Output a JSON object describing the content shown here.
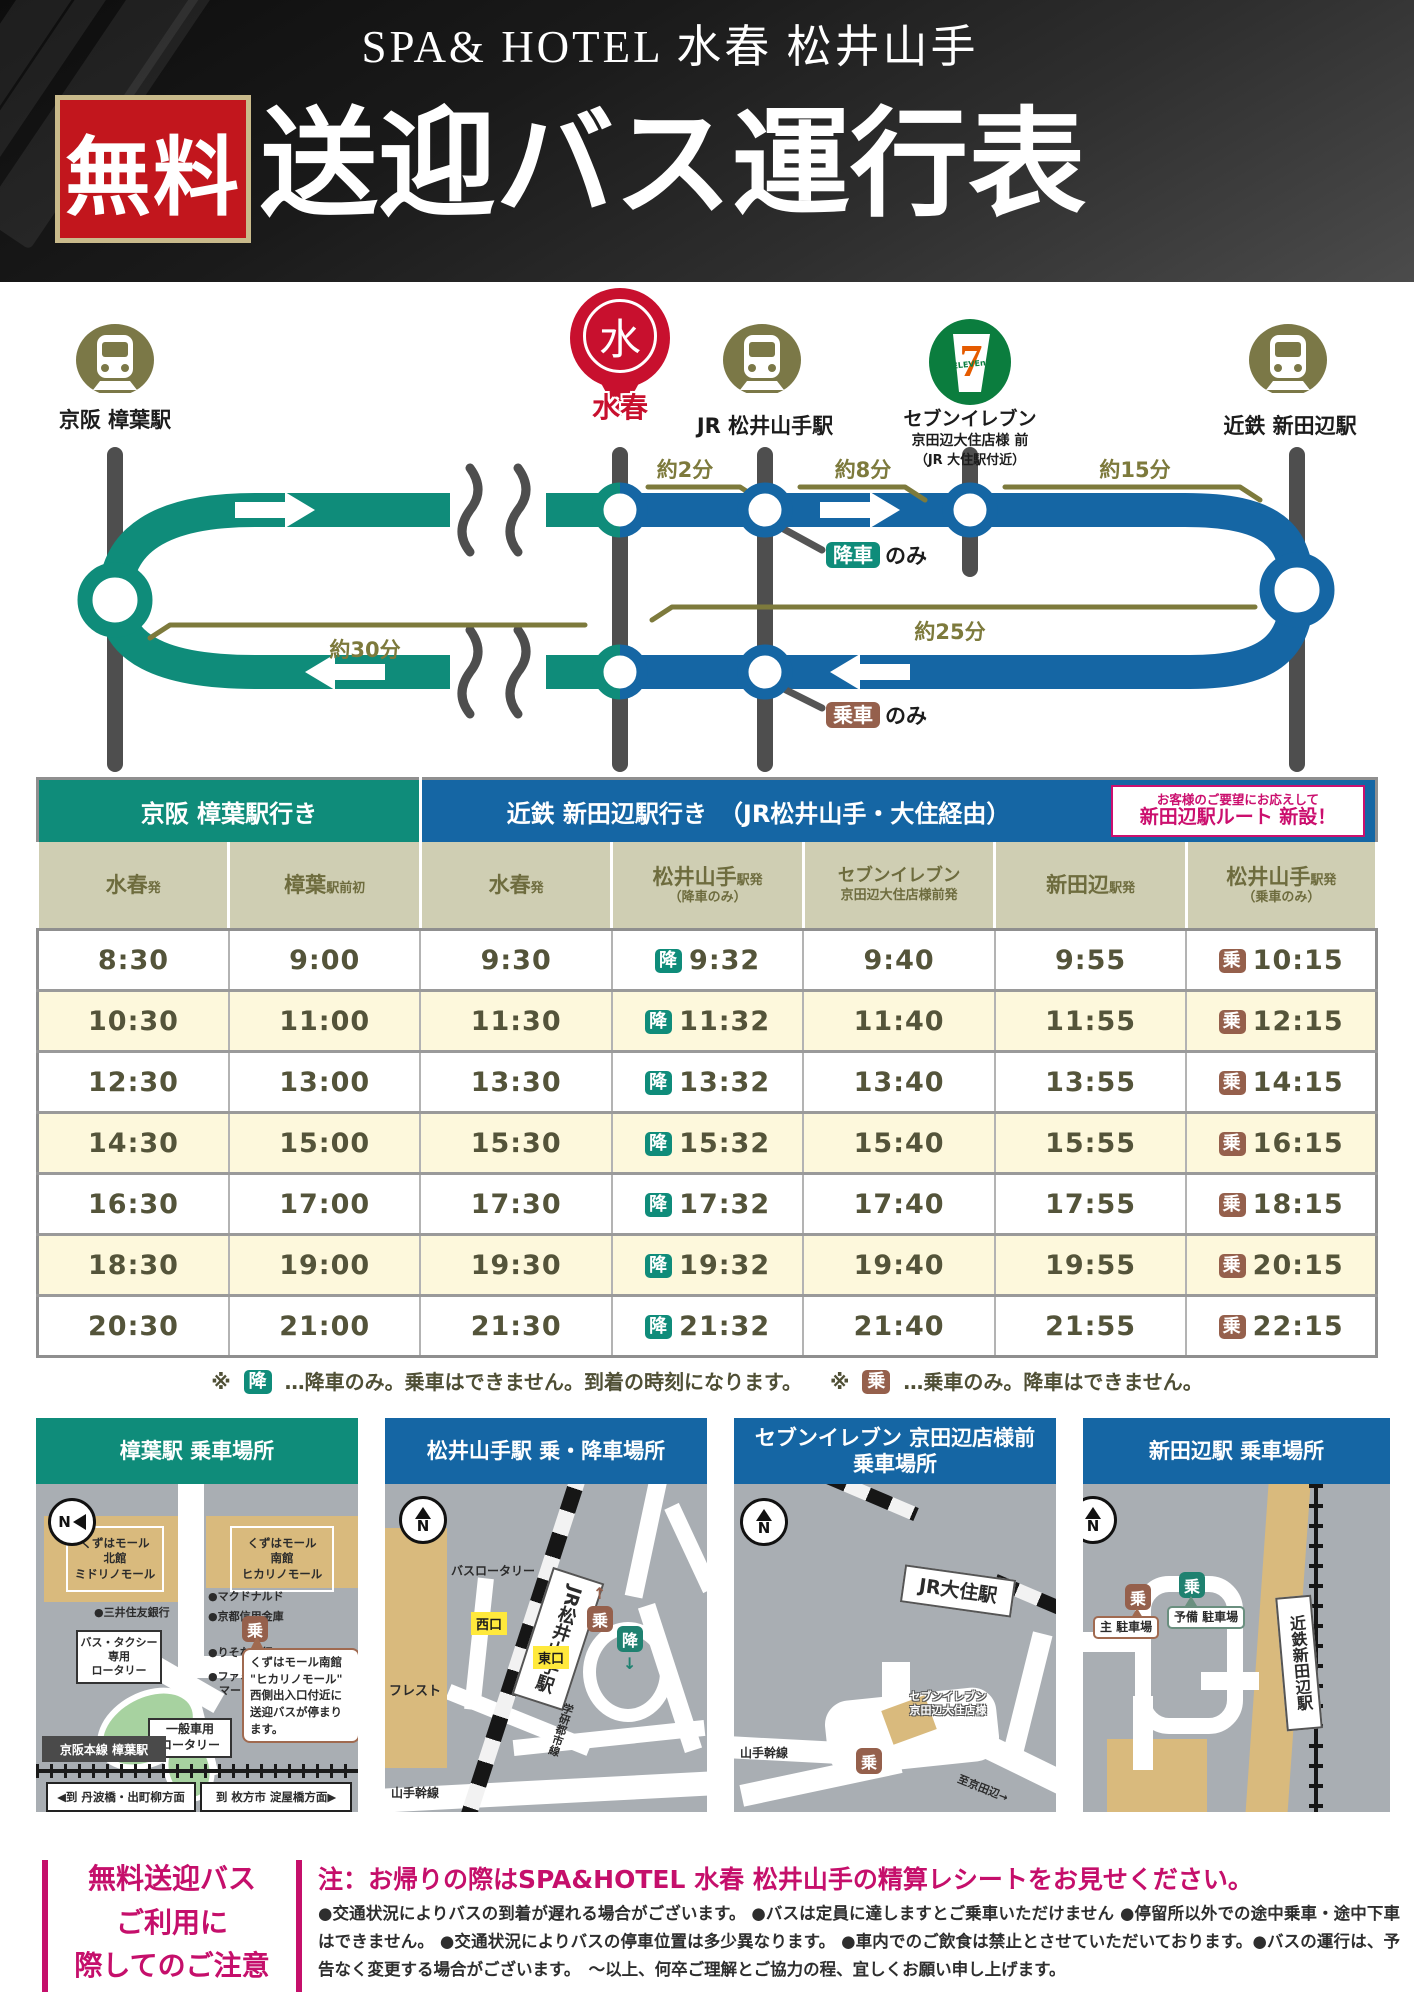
{
  "header": {
    "brand": "SPA& HOTEL 水春 松井山手",
    "free_badge": "無料",
    "title": "送迎バス運行表"
  },
  "route": {
    "colors": {
      "teal": "#0f8c7a",
      "blue": "#1566a4",
      "olive": "#7d7a3c"
    },
    "stations": {
      "kuzuha": {
        "label": "京阪 樟葉駅"
      },
      "suisyun": {
        "pin_char": "水",
        "pin_label": "水春"
      },
      "jr": {
        "label": "JR 松井山手駅"
      },
      "seven": {
        "label": "セブンイレブン",
        "sub1": "京田辺大住店様 前",
        "sub2": "（JR 大住駅付近）"
      },
      "kintetsu": {
        "label": "近鉄 新田辺駅"
      }
    },
    "durations": {
      "t2": "約2分",
      "t8": "約8分",
      "t15": "約15分",
      "t25": "約25分",
      "t30": "約30分"
    },
    "dropoff": {
      "badge": "降車",
      "suffix": "のみ"
    },
    "boarding": {
      "badge": "乗車",
      "suffix": "のみ"
    }
  },
  "timetable": {
    "direction_left": "京阪 樟葉駅行き",
    "direction_right": "近鉄 新田辺駅行き　（JR松井山手・大住経由）",
    "new_route_note_line1": "お客様のご要望にお応えして",
    "new_route_note_line2": "新田辺駅ルート 新設！",
    "drop_badge": "降",
    "board_badge": "乗",
    "columns": [
      {
        "main": "水春",
        "suffix": "発"
      },
      {
        "main": "樟葉",
        "suffix": "駅前初"
      },
      {
        "main": "水春",
        "suffix": "発"
      },
      {
        "main": "松井山手",
        "suffix": "駅発",
        "sub": "（降車のみ）"
      },
      {
        "main": "セブンイレブン",
        "suffix": "",
        "sub": "京田辺大住店様前発"
      },
      {
        "main": "新田辺",
        "suffix": "駅発"
      },
      {
        "main": "松井山手",
        "suffix": "駅発",
        "sub": "（乗車のみ）"
      }
    ],
    "rows": [
      [
        "8:30",
        "9:00",
        "9:30",
        "9:32",
        "9:40",
        "9:55",
        "10:15"
      ],
      [
        "10:30",
        "11:00",
        "11:30",
        "11:32",
        "11:40",
        "11:55",
        "12:15"
      ],
      [
        "12:30",
        "13:00",
        "13:30",
        "13:32",
        "13:40",
        "13:55",
        "14:15"
      ],
      [
        "14:30",
        "15:00",
        "15:30",
        "15:32",
        "15:40",
        "15:55",
        "16:15"
      ],
      [
        "16:30",
        "17:00",
        "17:30",
        "17:32",
        "17:40",
        "17:55",
        "18:15"
      ],
      [
        "18:30",
        "19:00",
        "19:30",
        "19:32",
        "19:40",
        "19:55",
        "20:15"
      ],
      [
        "20:30",
        "21:00",
        "21:30",
        "21:32",
        "21:40",
        "21:55",
        "22:15"
      ]
    ]
  },
  "legend": {
    "mark1": "※",
    "drop_badge": "降",
    "drop_text": "…降車のみ。乗車はできません。到着の時刻になります。",
    "mark2": "※",
    "board_badge": "乗",
    "board_text": "…乗車のみ。降車はできません。"
  },
  "maps": {
    "map1": {
      "title": "樟葉駅 乗車場所",
      "north": "N",
      "mall_north": "くずはモール\n北館\nミドリノモール",
      "mall_south": "くずはモール\n南館\nヒカリノモール",
      "poi_mcdonalds": "●マクドナルド",
      "poi_mitsui": "●三井住友銀行",
      "poi_kyoto_shinkin": "●京都信用金庫",
      "poi_risona": "●りそな銀行",
      "poi_famima": "●ファミリー\n　マート",
      "rotary_bus": "バス・タクシー\n専用\nロータリー",
      "board_badge": "乗",
      "callout": "くずはモール南館\n\"ヒカリノモール\"\n西側出入口付近に\n送迎バスが停まり\nます。",
      "rotary_general": "一般車用\nロータリー",
      "station_box": "京阪本線 樟葉駅",
      "dir_left": "◀到 丹波橋・出町柳方面",
      "dir_right": "到 枚方市 淀屋橋方面▶"
    },
    "map2": {
      "title": "松井山手駅 乗・降車場所",
      "north": "N",
      "furesuto": "フレスト",
      "bus_rotary": "バスロータリー",
      "station": "JR松井山手駅",
      "west": "西口",
      "east": "東口",
      "board_badge": "乗",
      "drop_badge": "降",
      "up_arrow": "↑",
      "down_arrow": "↓",
      "gakken": "学研都市線",
      "yamate": "山手幹線"
    },
    "map3": {
      "title_l1": "セブンイレブン 京田辺店様前",
      "title_l2": "乗車場所",
      "north": "N",
      "station": "JR大住駅",
      "yamate": "山手幹線",
      "seven_label": "セブンイレブン\n京田辺大住店様",
      "board_badge": "乗",
      "to_kyotanabe": "至京田辺→"
    },
    "map4": {
      "title": "新田辺駅 乗車場所",
      "north": "N",
      "station": "近鉄新田辺駅",
      "board_main": "乗",
      "main_lot": "主 駐車場",
      "board_reserve": "乗",
      "reserve_lot": "予備 駐車場"
    }
  },
  "notice": {
    "left_l1": "無料送迎バス",
    "left_l2": "ご利用に",
    "left_l3": "際してのご注意",
    "headline": "注：お帰りの際はSPA&HOTEL 水春 松井山手の精算レシートをお見せください。",
    "body": "●交通状況によりバスの到着が遅れる場合がございます。 ●バスは定員に達しますとご乗車いただけません ●停留所以外での途中乗車・途中下車はできません。 ●交通状況によりバスの停車位置は多少異なります。 ●車内でのご飲食は禁止とさせていただいております。●バスの運行は、予告なく変更する場合がございます。　～以上、何卒ご理解とご協力の程、宜しくお願い申し上げます。"
  }
}
